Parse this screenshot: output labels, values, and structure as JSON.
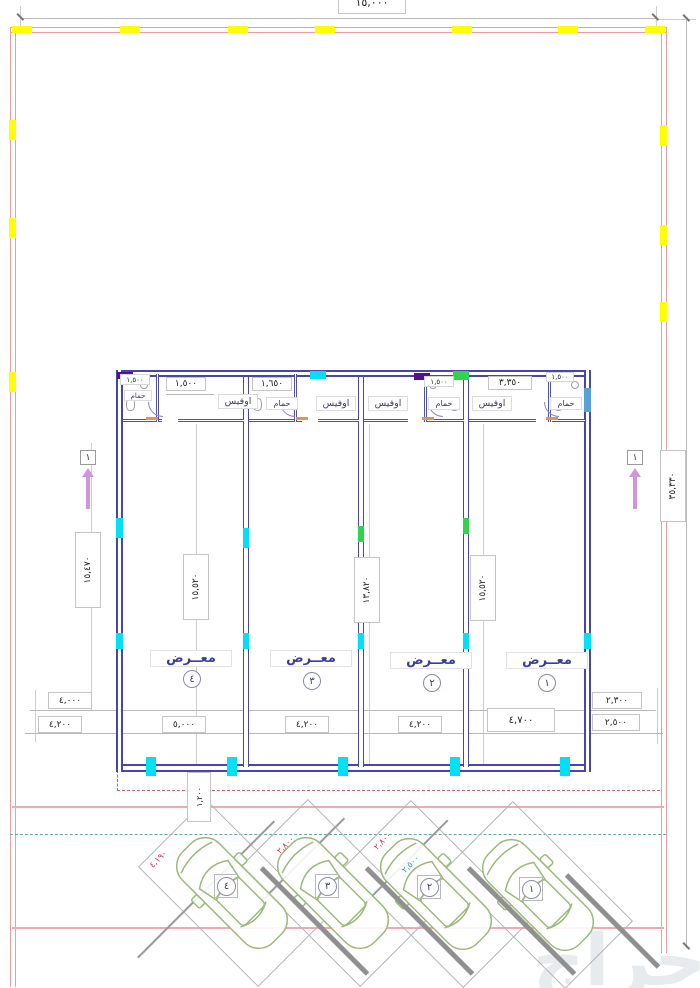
{
  "site": {
    "top_width_dim": "١٥,٠٠٠",
    "right_height_dim": "٣٥,٣٣٠",
    "left_height_dim": "١٥,٤٧٠",
    "offset_dim": "١,٢٠٠",
    "section_marker_left": "١",
    "section_marker_right": "١",
    "left_dims": [
      "٤,٠٠٠",
      "٤,٢٠٠"
    ],
    "right_dims": [
      "٢,٣٠٠",
      "٢,٥٠٠"
    ]
  },
  "building": {
    "column_dims": [
      "١٥,٥٢٠",
      "١٣,٨٢٠",
      "١٥,٥٢٠"
    ],
    "units": [
      {
        "label": "معــرض",
        "number": "٤",
        "width_dim": "٥,٠٠٠",
        "office": "اوفيس",
        "bath": "حمام",
        "top_dims": [
          "١,٥٠٠",
          "١,٥٠٠"
        ]
      },
      {
        "label": "معــرض",
        "number": "٣",
        "width_dim": "٤,٢٠٠",
        "office": "اوفيس",
        "bath": "حمام",
        "top_dims": [
          "١,٦٥٠"
        ]
      },
      {
        "label": "معــرض",
        "number": "٢",
        "width_dim": "٤,٢٠٠",
        "office": "اوفيس",
        "bath": "حمام",
        "top_dims": [
          "١,٥٠٠"
        ]
      },
      {
        "label": "معــرض",
        "number": "١",
        "width_dim": "٤,٧٠٠",
        "office": "اوفيس",
        "bath": "حمام",
        "top_dims": [
          "٣,٣٥٠",
          "١,٥٠٠"
        ]
      }
    ]
  },
  "parking": {
    "stalls": [
      {
        "number": "٤",
        "dim": "٤,١٩٠"
      },
      {
        "number": "٣",
        "dim": "٢,٨٠٠"
      },
      {
        "number": "٢",
        "dim": "٢,٨٠٠"
      },
      {
        "number": "١",
        "dim": "٢,٥٠٠"
      }
    ]
  },
  "watermark": "حراج",
  "colors": {
    "wall": "#4646ad",
    "boundary": "#ef9aa4",
    "marker_yellow": "#ffff00",
    "highlight_cyan": "#00e0f8",
    "highlight_green": "#2ed44c",
    "highlight_purple": "#55108f",
    "door_blue": "#58a0d8",
    "dim_red": "#c23b5a",
    "car_outline": "#9cb87a",
    "label_blue": "#3d3da0"
  }
}
